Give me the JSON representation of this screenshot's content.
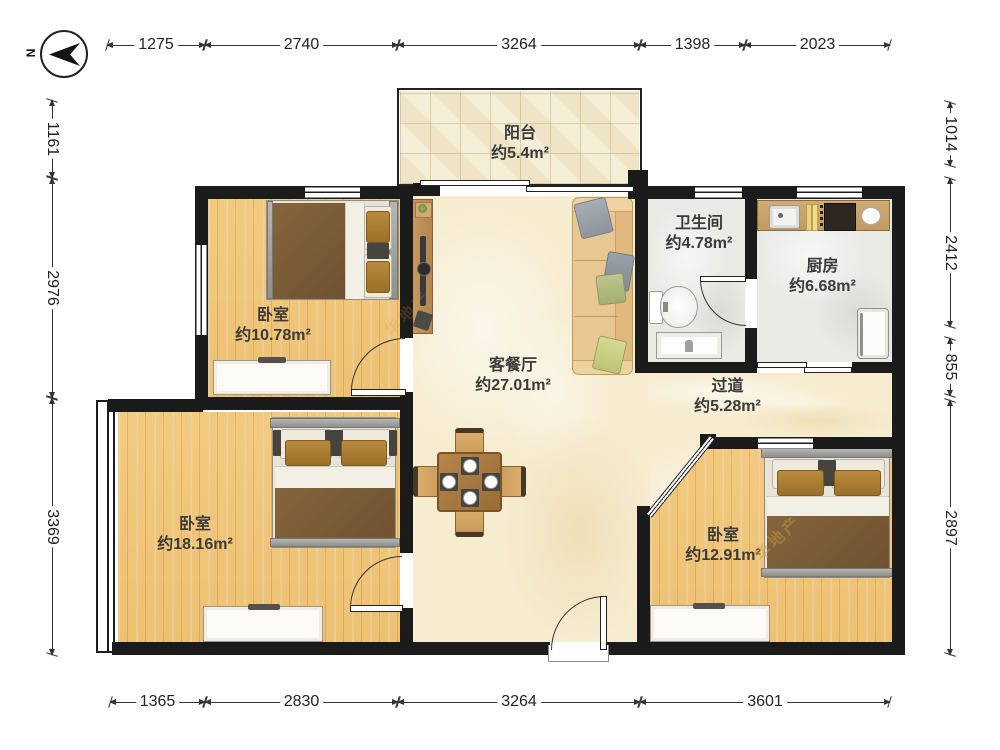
{
  "title": "户型图",
  "compass": {
    "north_label": "N"
  },
  "dims": {
    "top": [
      "1275",
      "2740",
      "3264",
      "1398",
      "2023"
    ],
    "bottom": [
      "1365",
      "2830",
      "3264",
      "3601"
    ],
    "left": [
      "1161",
      "2976",
      "3369"
    ],
    "right": [
      "1014",
      "2412",
      "855",
      "2897"
    ]
  },
  "rooms": {
    "balcony": {
      "name": "阳台",
      "area": "约5.4m²"
    },
    "bedroom_top_left": {
      "name": "卧室",
      "area": "约10.78m²"
    },
    "living_dining": {
      "name": "客餐厅",
      "area": "约27.01m²"
    },
    "bathroom": {
      "name": "卫生间",
      "area": "约4.78m²"
    },
    "kitchen": {
      "name": "厨房",
      "area": "约6.68m²"
    },
    "hallway": {
      "name": "过道",
      "area": "约5.28m²"
    },
    "bedroom_bottom_left": {
      "name": "卧室",
      "area": "约18.16m²"
    },
    "bedroom_bottom_right": {
      "name": "卧室",
      "area": "约12.91m²"
    }
  },
  "watermark": "华地产",
  "colors": {
    "wall": "#1b1b1b",
    "wood_floor": "#f0c87e",
    "living_floor": "#f6ecd0",
    "wet_floor": "#e9e9e6",
    "counter": "#c9a368",
    "blanket": "#75572f",
    "sofa": "#e9c793"
  }
}
